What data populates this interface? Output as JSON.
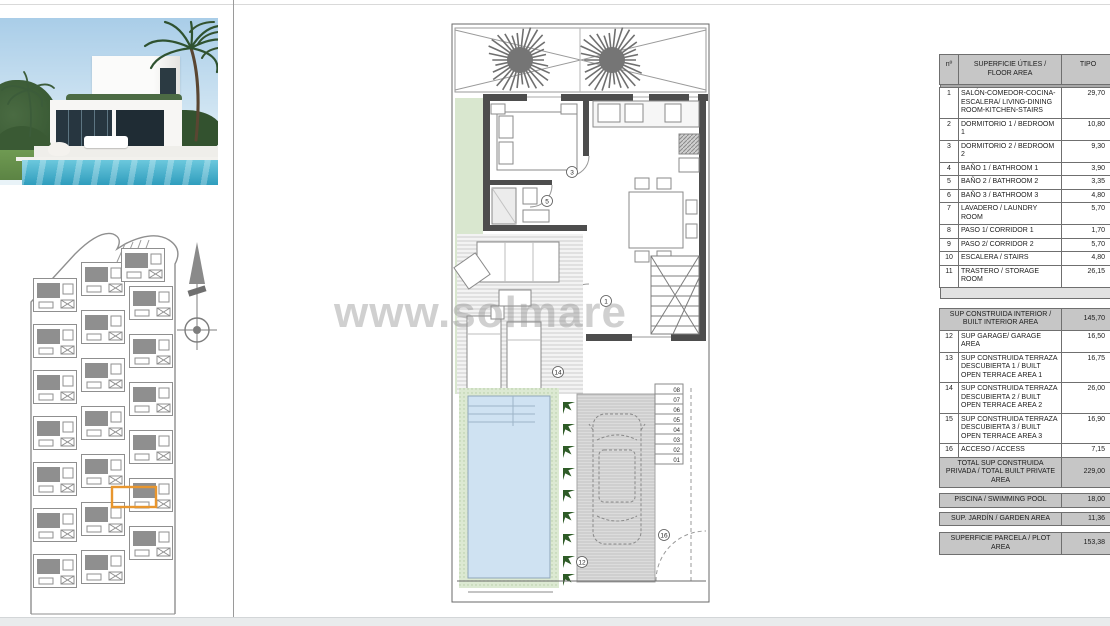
{
  "watermark": {
    "text": "www.solmare"
  },
  "colors": {
    "highlight_orange": "#e8962e",
    "pool_blue": "#cfe2f2",
    "plant_green": "#2e5b27",
    "garden_green": "#d9e7cf",
    "wall_gray": "#4d4d4d",
    "table_header_bg": "#c6c6c6"
  },
  "floor_plan": {
    "labels": {
      "living": "1",
      "bedroom_door": "3",
      "bathroom": "5",
      "driveway": "12",
      "terrace": "14",
      "access": "16"
    },
    "step_numbers": [
      "08",
      "07",
      "06",
      "05",
      "04",
      "03",
      "02",
      "01"
    ]
  },
  "area_table": {
    "header": {
      "num": "nº",
      "label": "SUPERFICIE ÚTILES / FLOOR AREA",
      "value": "TIPO"
    },
    "rows": [
      {
        "kind": "bar"
      },
      {
        "kind": "item",
        "num": "1",
        "label": "SALÓN-COMEDOR-COCINA-ESCALERA/ LIVING-DINING ROOM-KITCHEN-STAIRS",
        "value": "29,70"
      },
      {
        "kind": "item",
        "num": "2",
        "label": "DORMITORIO 1 / BEDROOM 1",
        "value": "10,80"
      },
      {
        "kind": "item",
        "num": "3",
        "label": "DORMITORIO 2 / BEDROOM 2",
        "value": "9,30"
      },
      {
        "kind": "item",
        "num": "4",
        "label": "BAÑO 1 / BATHROOM 1",
        "value": "3,90"
      },
      {
        "kind": "item",
        "num": "5",
        "label": "BAÑO 2 / BATHROOM 2",
        "value": "3,35"
      },
      {
        "kind": "item",
        "num": "6",
        "label": "BAÑO 3 / BATHROOM 3",
        "value": "4,80"
      },
      {
        "kind": "item",
        "num": "7",
        "label": "LAVADERO / LAUNDRY ROOM",
        "value": "5,70"
      },
      {
        "kind": "item",
        "num": "8",
        "label": "PASO 1/ CORRIDOR 1",
        "value": "1,70"
      },
      {
        "kind": "item",
        "num": "9",
        "label": "PASO 2/ CORRIDOR 2",
        "value": "5,70"
      },
      {
        "kind": "item",
        "num": "10",
        "label": "ESCALERA / STAIRS",
        "value": "4,80"
      },
      {
        "kind": "item",
        "num": "11",
        "label": "TRASTERO / STORAGE ROOM",
        "value": "26,15"
      },
      {
        "kind": "blank"
      },
      {
        "kind": "gap",
        "h": 10
      },
      {
        "kind": "section",
        "label": "SUP CONSTRUIDA INTERIOR / BUILT INTERIOR AREA",
        "value": "145,70"
      },
      {
        "kind": "item",
        "num": "12",
        "label": "SUP GARAGE/ GARAGE AREA",
        "value": "16,50"
      },
      {
        "kind": "item",
        "num": "13",
        "label": "SUP CONSTRUIDA TERRAZA DESCUBIERTA 1 / BUILT OPEN TERRACE AREA 1",
        "value": "16,75"
      },
      {
        "kind": "item",
        "num": "14",
        "label": "SUP CONSTRUIDA TERRAZA DESCUBIERTA 2 / BUILT OPEN TERRACE AREA 2",
        "value": "26,00"
      },
      {
        "kind": "item",
        "num": "15",
        "label": "SUP CONSTRUIDA TERRAZA DESCUBIERTA 3 / BUILT OPEN TERRACE AREA 3",
        "value": "16,90"
      },
      {
        "kind": "item",
        "num": "16",
        "label": "ACCESO / ACCESS",
        "value": "7,15"
      },
      {
        "kind": "section",
        "label": "TOTAL SUP CONSTRUIDA PRIVADA / TOTAL BUILT PRIVATE AREA",
        "value": "229,00"
      },
      {
        "kind": "gap",
        "h": 6
      },
      {
        "kind": "section",
        "label": "PISCINA / SWIMMING POOL",
        "value": "18,00"
      },
      {
        "kind": "gap",
        "h": 5
      },
      {
        "kind": "section",
        "label": "SUP. JARDÍN / GARDEN AREA",
        "value": "11,36"
      },
      {
        "kind": "gap",
        "h": 7
      },
      {
        "kind": "section",
        "label": "SUPERFICIE PARCELA / PLOT AREA",
        "value": "153,38"
      }
    ]
  }
}
